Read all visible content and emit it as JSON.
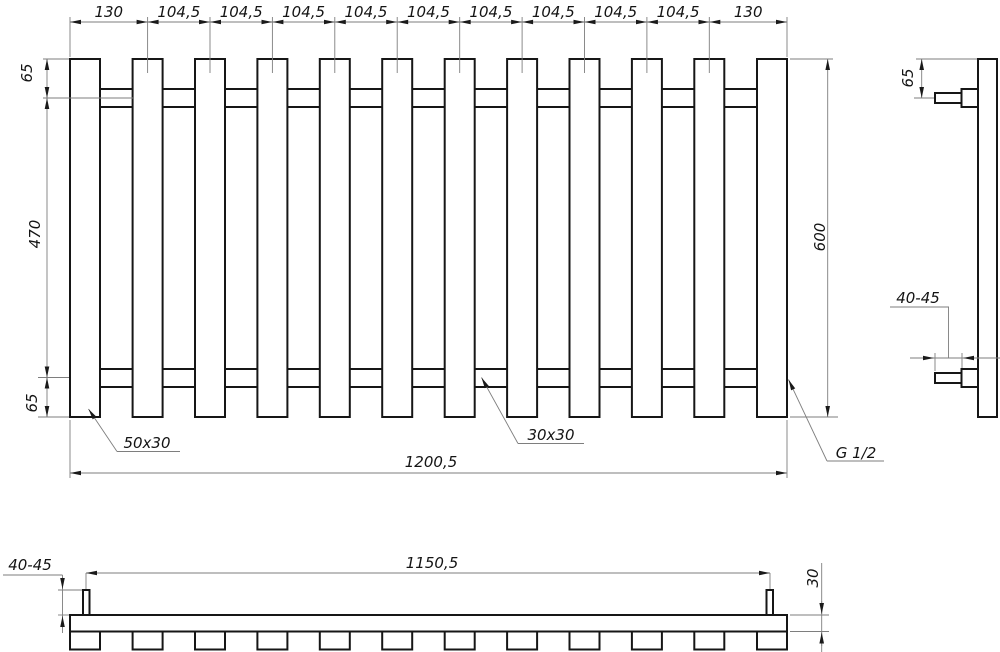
{
  "front_view": {
    "top_dims": [
      "130",
      "104,5",
      "104,5",
      "104,5",
      "104,5",
      "104,5",
      "104,5",
      "104,5",
      "104,5",
      "104,5",
      "130"
    ],
    "left_dim_top": "65",
    "left_dim_middle": "470",
    "left_dim_bottom": "65",
    "right_dim": "600",
    "bottom_dim": "1200,5",
    "label_outer_profile": "50x30",
    "label_inner_profile": "30x30",
    "label_thread": "G 1/2"
  },
  "side_view": {
    "top_dim": "65",
    "protrusion_dim": "40-45"
  },
  "plan_view": {
    "protrusion_dim": "40-45",
    "centers_dim": "1150,5",
    "depth_dim": "30"
  },
  "colors": {
    "outline": "#161616",
    "dimension_line": "#7e7e7e",
    "background": "#ffffff"
  }
}
